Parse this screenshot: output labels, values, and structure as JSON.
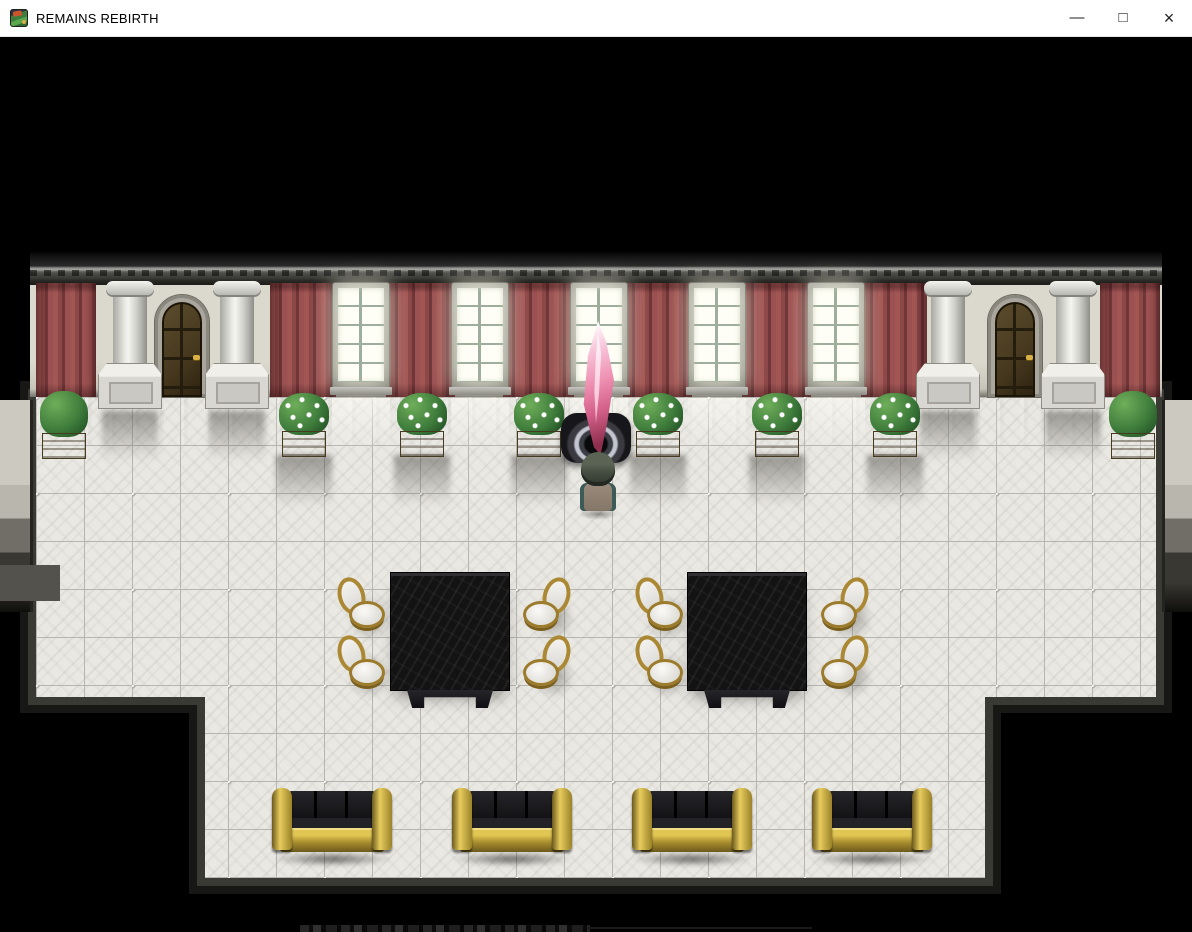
{
  "titlebar": {
    "title": "REMAINS REBIRTH",
    "controls": [
      {
        "name": "minimize",
        "glyph": "—"
      },
      {
        "name": "maximize",
        "glyph": "□"
      },
      {
        "name": "close",
        "glyph": "×"
      }
    ]
  },
  "game": {
    "viewport_label": "mansion-hall-scene",
    "palette": {
      "background": "#000000",
      "wall": "#d6d3c9",
      "curtain_red": "#9b5151",
      "curtain_shadow": "#6f3537",
      "floor_tile": "#eae8e3",
      "floor_line": "#b7b5af",
      "table_black": "#131313",
      "gold_trim": "#c7a93c",
      "crystal_pink": "#ee8fb0",
      "window_glow": "#fffef6",
      "door_brown": "#46381e"
    },
    "wall": {
      "x": 30,
      "y": 214,
      "w": 1132,
      "cornice_h": 34,
      "body_y": 244,
      "body_h": 116
    },
    "curtains": [
      {
        "x": 36,
        "w": 60
      },
      {
        "x": 270,
        "w": 66
      },
      {
        "x": 386,
        "w": 69
      },
      {
        "x": 503,
        "w": 71
      },
      {
        "x": 623,
        "w": 69
      },
      {
        "x": 742,
        "w": 69
      },
      {
        "x": 861,
        "w": 66
      },
      {
        "x": 1100,
        "w": 60
      }
    ],
    "windows": [
      {
        "x": 336
      },
      {
        "x": 455
      },
      {
        "x": 574
      },
      {
        "x": 692
      },
      {
        "x": 811
      }
    ],
    "window_size": {
      "w": 50,
      "y": 246,
      "h": 110
    },
    "doors": [
      {
        "x": 155
      },
      {
        "x": 988
      }
    ],
    "door_size": {
      "w": 54,
      "y": 258,
      "h": 102
    },
    "columns": [
      {
        "x": 110
      },
      {
        "x": 217
      },
      {
        "x": 928
      },
      {
        "x": 1053
      }
    ],
    "column_size": {
      "w": 40,
      "y": 244,
      "shaft_h": 96,
      "ped_y": 326,
      "ped_h": 46
    },
    "floor_polygon": [
      [
        36,
        360
      ],
      [
        1156,
        360
      ],
      [
        1156,
        660
      ],
      [
        985,
        660
      ],
      [
        985,
        841
      ],
      [
        205,
        841
      ],
      [
        205,
        660
      ],
      [
        36,
        660
      ]
    ],
    "floor_rim1": [
      [
        28,
        352
      ],
      [
        1164,
        352
      ],
      [
        1164,
        668
      ],
      [
        993,
        668
      ],
      [
        993,
        849
      ],
      [
        197,
        849
      ],
      [
        197,
        668
      ],
      [
        28,
        668
      ]
    ],
    "floor_rim2": [
      [
        20,
        344
      ],
      [
        1172,
        344
      ],
      [
        1172,
        676
      ],
      [
        1001,
        676
      ],
      [
        1001,
        857
      ],
      [
        189,
        857
      ],
      [
        189,
        676
      ],
      [
        20,
        676
      ]
    ],
    "flower_planters": [
      {
        "x": 279
      },
      {
        "x": 397
      },
      {
        "x": 514
      },
      {
        "x": 633
      },
      {
        "x": 752
      },
      {
        "x": 870
      }
    ],
    "bush_planters": [
      {
        "x": 40
      },
      {
        "x": 1109
      }
    ],
    "planter_y": 356,
    "crystal": {
      "pedestal": {
        "x": 561,
        "y": 376,
        "w": 70,
        "h": 50
      },
      "shard": {
        "x": 577,
        "y": 284,
        "w": 42,
        "h": 134
      }
    },
    "player": {
      "x": 578,
      "y": 415,
      "w": 40,
      "h": 64
    },
    "tables": [
      {
        "x": 391
      },
      {
        "x": 688
      }
    ],
    "table_size": {
      "y": 536,
      "w": 118,
      "h": 117,
      "base_h": 18
    },
    "chairs": [
      {
        "x": 339,
        "y": 542,
        "facing": "right"
      },
      {
        "x": 339,
        "y": 600,
        "facing": "right"
      },
      {
        "x": 523,
        "y": 542,
        "facing": "left"
      },
      {
        "x": 523,
        "y": 600,
        "facing": "left"
      },
      {
        "x": 637,
        "y": 542,
        "facing": "right"
      },
      {
        "x": 637,
        "y": 600,
        "facing": "right"
      },
      {
        "x": 821,
        "y": 542,
        "facing": "left"
      },
      {
        "x": 821,
        "y": 600,
        "facing": "left"
      }
    ],
    "sofas": [
      {
        "x": 272
      },
      {
        "x": 452
      },
      {
        "x": 632
      },
      {
        "x": 812
      }
    ],
    "sofa_y": 751,
    "edge_walls": {
      "left": {
        "x": 0,
        "y": 363,
        "w": 30,
        "h": 212
      },
      "right": {
        "x": 1162,
        "y": 363,
        "w": 30,
        "h": 212
      },
      "left_step": {
        "x": 0,
        "y": 528,
        "w": 60,
        "h": 36
      }
    },
    "cutoff_strip": {
      "x": 300,
      "y": 888,
      "w": 290,
      "h": 7,
      "line_x": 588,
      "line_w": 224
    }
  }
}
